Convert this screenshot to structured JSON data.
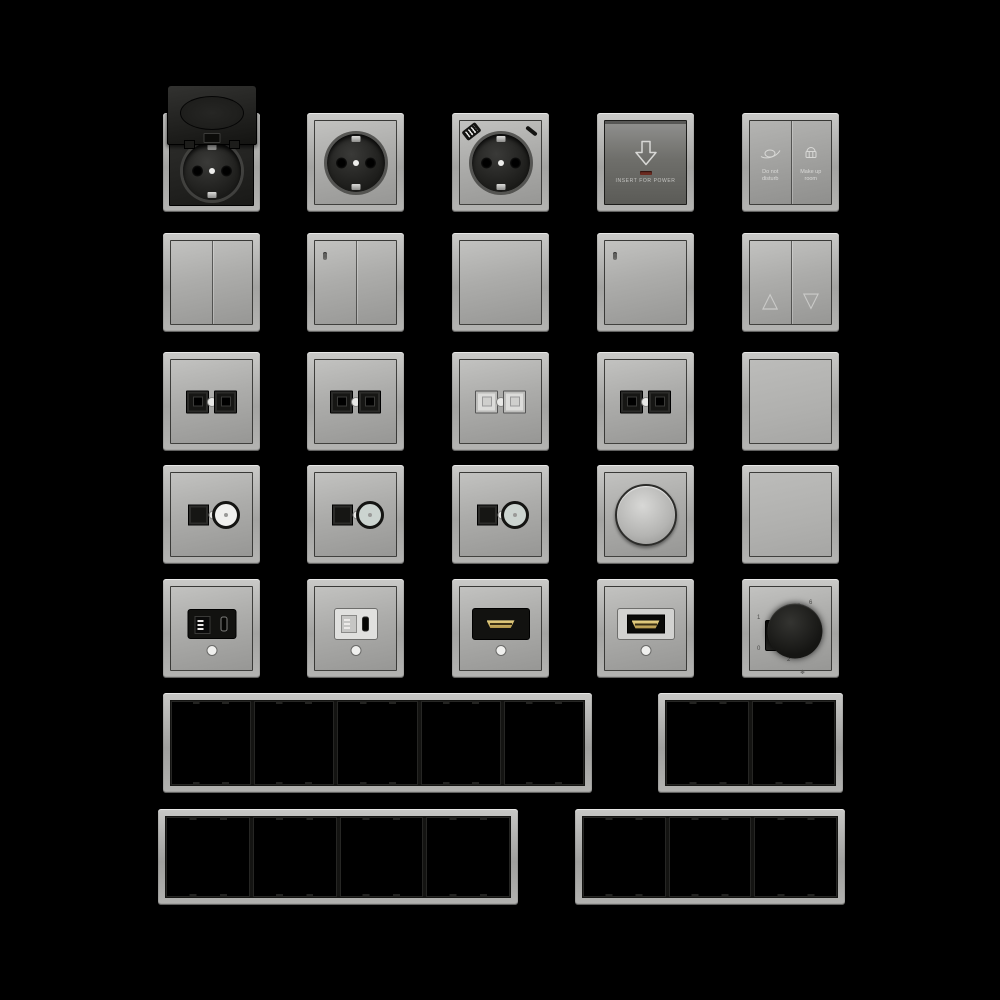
{
  "canvas": {
    "background": "#000000"
  },
  "palette": {
    "frame_silver": "#b6b6b4",
    "plate_light": "#b2b2b0",
    "plate_dark": "#70706c",
    "insert_black": "#161614",
    "hdmi_gold": "#d6bd72",
    "led_red": "#6b2a20",
    "dot_white": "#ededeb"
  },
  "card_switch": {
    "label": "INSERT FOR POWER"
  },
  "hotel_switch": {
    "left_line1": "Do not",
    "left_line2": "disturb",
    "right_line1": "Make up",
    "right_line2": "room"
  },
  "thermostat": {
    "dial": [
      "6",
      "5",
      "4",
      "3",
      "2"
    ],
    "slider_top": "1",
    "slider_bottom": "0",
    "mode": "❄"
  },
  "modules": [
    {
      "id": "socket-hinged-lid",
      "name": "Schuko socket with hinged lid"
    },
    {
      "id": "schuko-socket",
      "name": "Schuko socket"
    },
    {
      "id": "schuko-socket-usb",
      "name": "Schuko socket with USB A and C"
    },
    {
      "id": "key-card-switch",
      "name": "Hotel key card power switch"
    },
    {
      "id": "hotel-service-switch",
      "name": "Do-not-disturb / make-up-room switch"
    },
    {
      "id": "rocker-2-gang",
      "name": "Two-gang rocker switch"
    },
    {
      "id": "rocker-2-gang-led",
      "name": "Two-gang rocker switch with indicator"
    },
    {
      "id": "rocker-1-gang",
      "name": "One-gang rocker switch"
    },
    {
      "id": "rocker-1-gang-led",
      "name": "One-gang rocker switch with indicator"
    },
    {
      "id": "blind-switch",
      "name": "Blind/shutter up-down switch"
    },
    {
      "id": "data-socket-black-1",
      "name": "Twin data socket black"
    },
    {
      "id": "data-socket-black-2",
      "name": "Twin data socket black"
    },
    {
      "id": "data-socket-white",
      "name": "Twin data socket white"
    },
    {
      "id": "data-socket-black-3",
      "name": "Twin data socket black"
    },
    {
      "id": "rocker-1-gang-plain",
      "name": "One-gang rocker switch"
    },
    {
      "id": "tv-data-socket-1",
      "name": "Data + coax TV socket"
    },
    {
      "id": "tv-data-socket-2",
      "name": "Data + coax TV socket"
    },
    {
      "id": "tv-data-socket-3",
      "name": "Data + coax TV socket"
    },
    {
      "id": "rotary-dimmer",
      "name": "Rotary dimmer"
    },
    {
      "id": "blank-cover",
      "name": "Blank cover plate"
    },
    {
      "id": "usb-charger-black",
      "name": "USB A+C charger black insert"
    },
    {
      "id": "usb-charger-white",
      "name": "USB A+C charger white insert"
    },
    {
      "id": "hdmi-socket-black",
      "name": "HDMI socket black insert"
    },
    {
      "id": "hdmi-socket-white",
      "name": "HDMI socket white insert"
    },
    {
      "id": "thermostat",
      "name": "Rotary thermostat"
    }
  ],
  "frames": [
    {
      "id": "frame-5-gang",
      "gangs": 5
    },
    {
      "id": "frame-2-gang",
      "gangs": 2
    },
    {
      "id": "frame-4-gang",
      "gangs": 4
    },
    {
      "id": "frame-3-gang",
      "gangs": 3
    }
  ]
}
